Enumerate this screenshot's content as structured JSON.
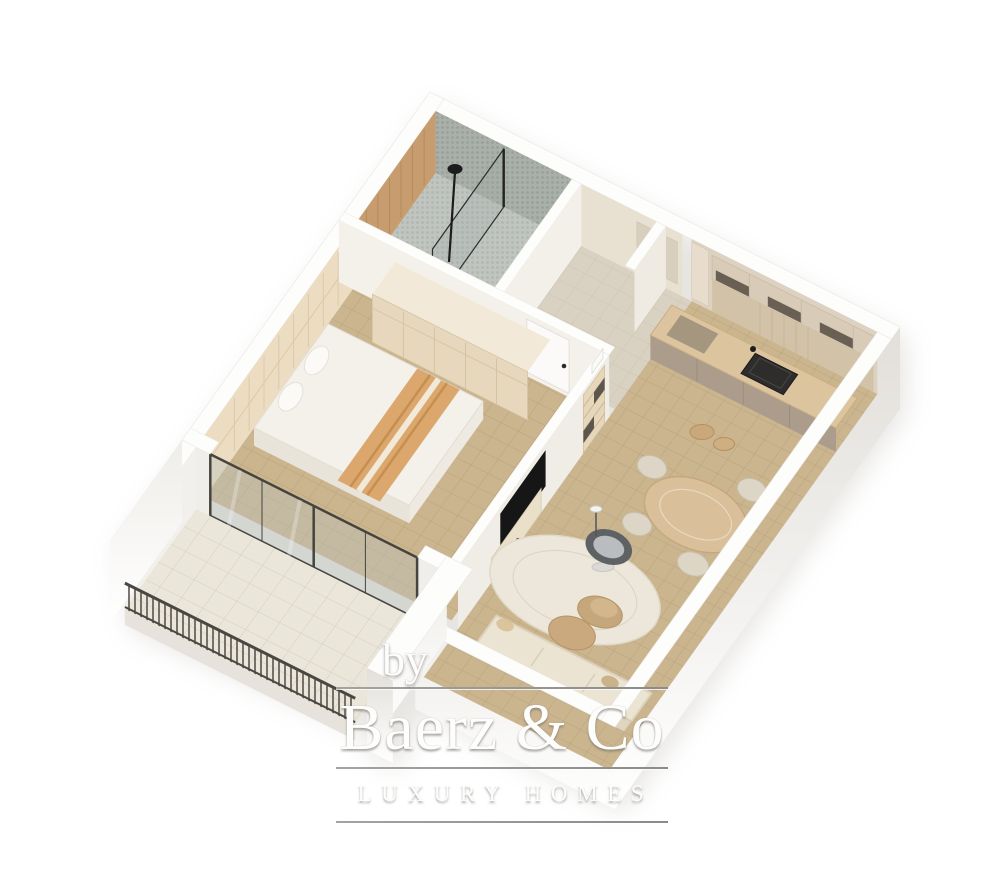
{
  "watermark": {
    "prefix": "by",
    "brand": "Baerz & Co",
    "tagline": "LUXURY HOMES"
  },
  "palette": {
    "background": "#ffffff",
    "wall_top": "#fdfdfc",
    "wall_face_light": "#efede9",
    "wall_face_dark": "#e3e0db",
    "floor_main": "#cbb58f",
    "floor_entry": "#d9d1c1",
    "floor_balcony": "#ebe6da",
    "floor_bathroom": "#c0c5c0",
    "mosaic_wall": "#a9afa9",
    "wood_wall": "#c79d6f",
    "wood_counter": "#dcc49e",
    "cabinet_taupe": "#ab9c8b",
    "cabinet_cream": "#d8ccb9",
    "furniture_cream": "#e7d8bd",
    "bed_linen": "#f4f1ea",
    "throw_orange": "#dba76d",
    "rug": "#ece7da",
    "sofa": "#ece4d2",
    "pouf": "#c6a67b",
    "papasan": "#5f6265",
    "tv_black": "#161616",
    "railing": "#4a4641",
    "glass": "#b6beba",
    "divider_line": "#8d8b88"
  }
}
